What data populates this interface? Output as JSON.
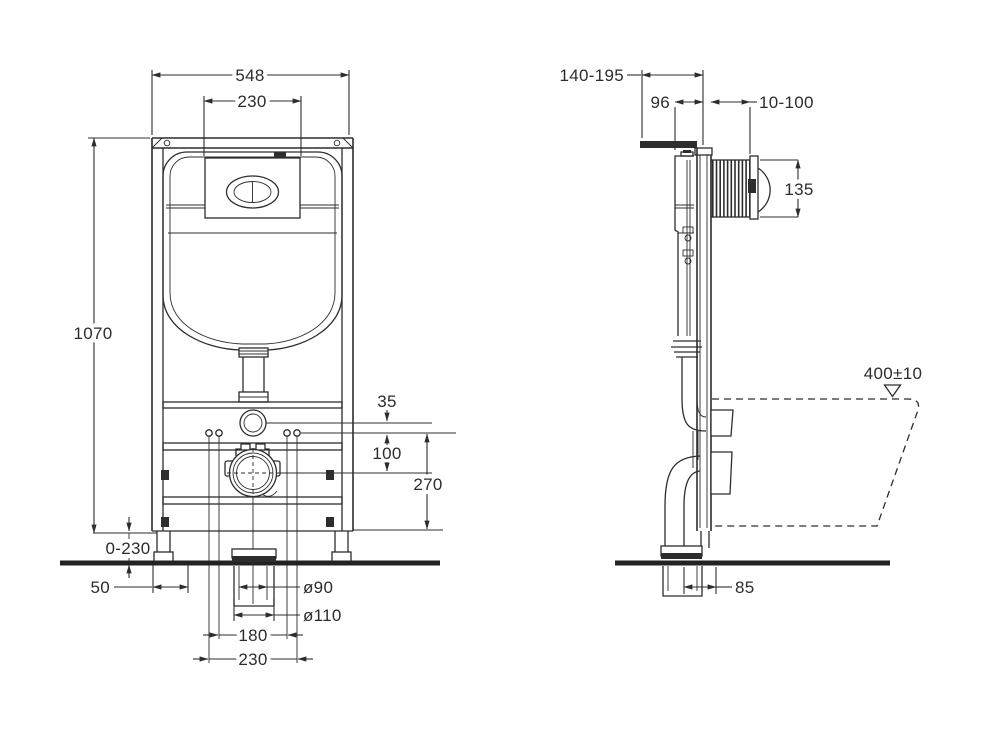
{
  "drawing": {
    "title": "concealed-cistern-installation-frame-dimensions",
    "background_color": "#ffffff",
    "line_color": "#2d2d2d",
    "front_view": {
      "frame_width": "548",
      "flush_plate_width": "230",
      "frame_height": "1070",
      "inlet_to_bolts": "35",
      "bolts_to_outlet": "100",
      "bolts_height": "270",
      "leg_adjustment": "0-230",
      "base_offset": "50",
      "outlet_pipe_diameter": "ø90",
      "outlet_socket_diameter": "ø110",
      "bolt_spacing_inner": "180",
      "bolt_spacing_outer": "230"
    },
    "side_view": {
      "installation_depth": "140-195",
      "frame_depth": "96",
      "wall_finish_range": "10-100",
      "access_box_height": "135",
      "bowl_top_height": "400±10",
      "outlet_to_wall": "85"
    }
  }
}
